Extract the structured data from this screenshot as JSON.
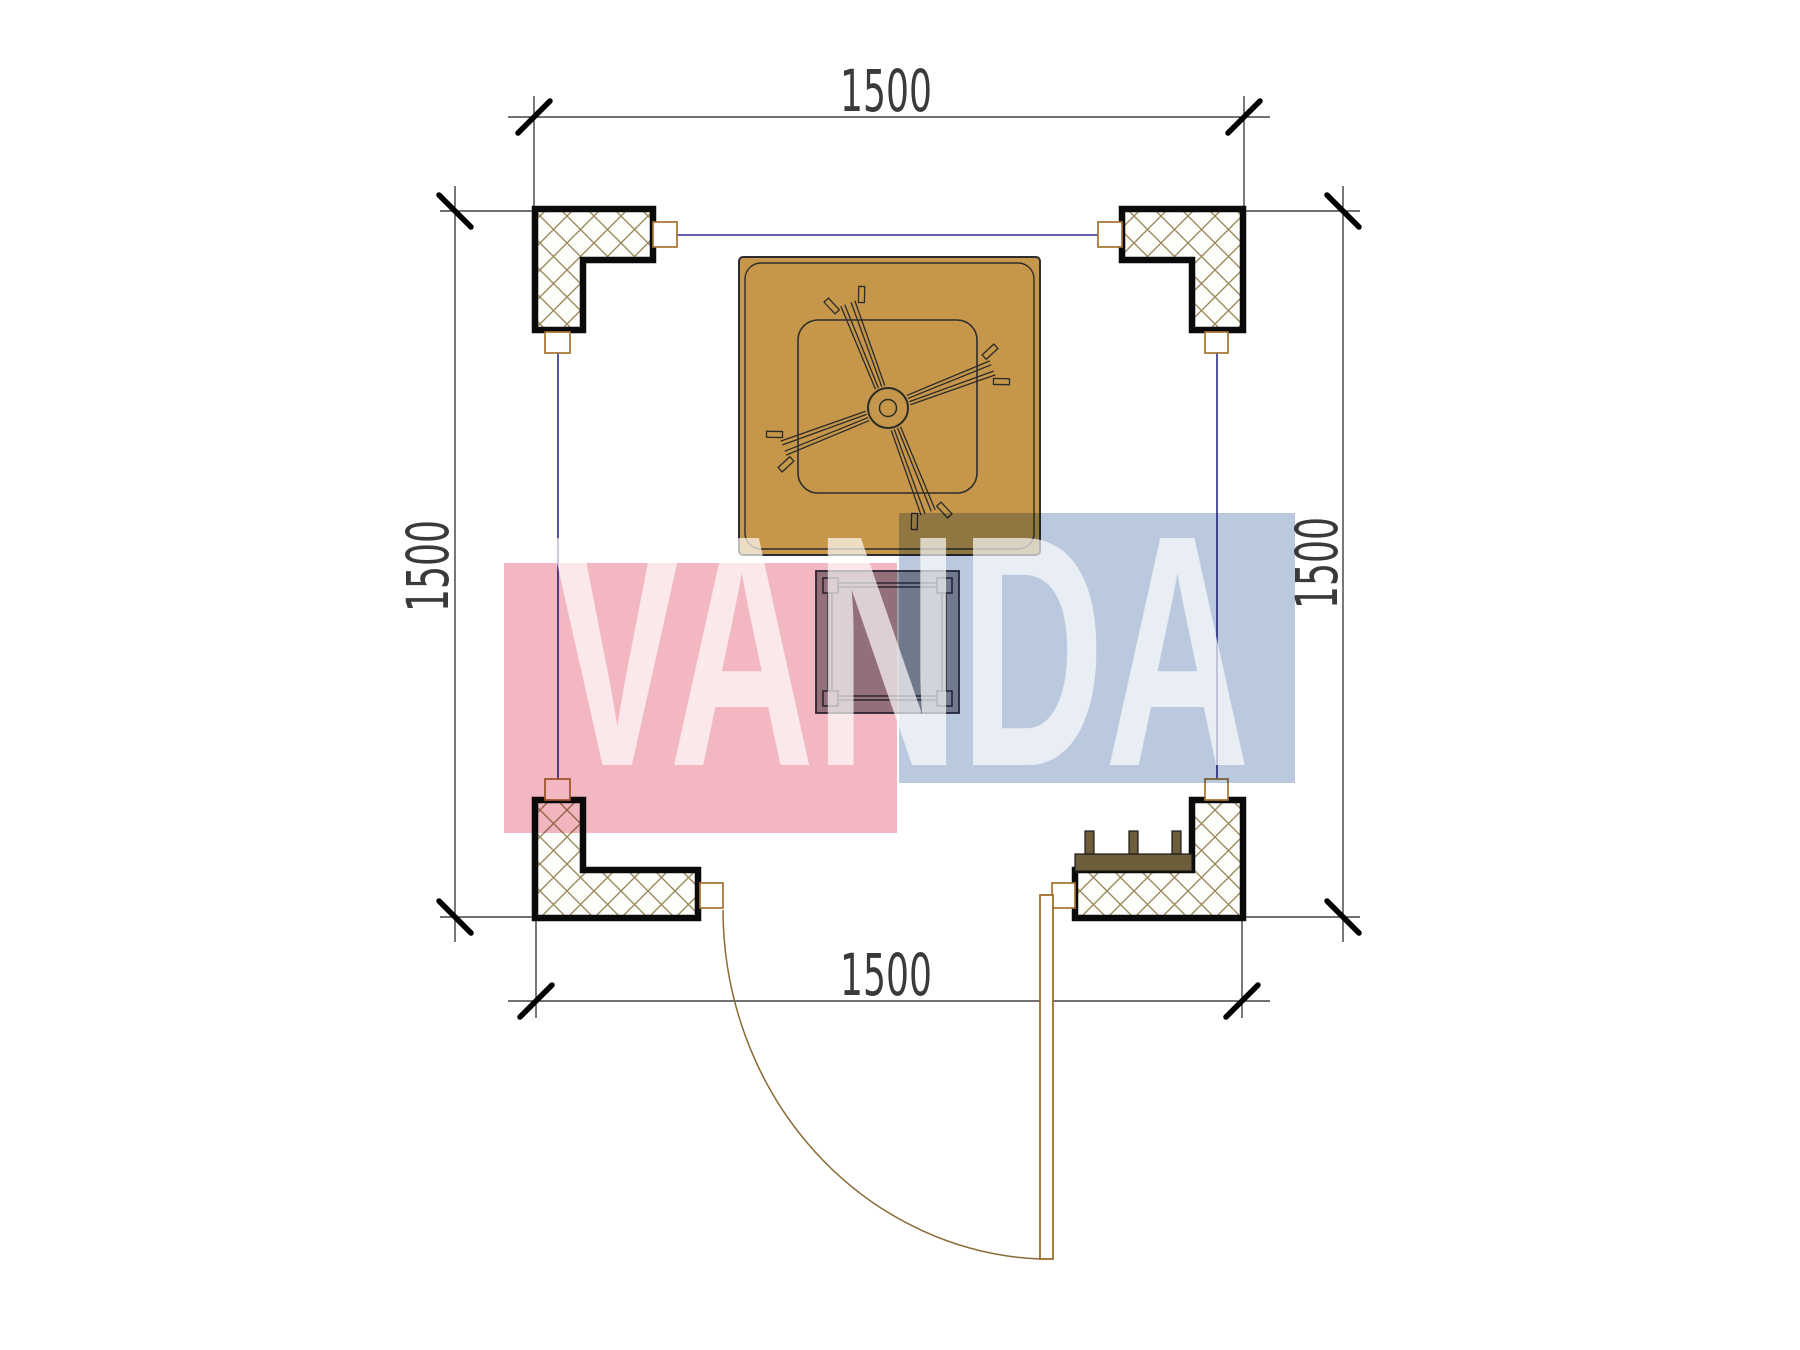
{
  "drawing_title": "pergola-floor-plan",
  "dimensions": {
    "top": "1500",
    "bottom": "1500",
    "left": "1500",
    "right": "1500"
  },
  "watermark": {
    "text": "VANDA",
    "pink_block_color": "#f2b7c1",
    "blue_block_color": "#bac9de",
    "text_color": "rgba(255,255,255,0.68)"
  },
  "colors": {
    "background": "#ffffff",
    "canopy_fill": "#c6974a",
    "canopy_line": "#2d2d2d",
    "hatch_line": "#9c8a5e",
    "column_outline": "#0a0a0a",
    "wall_line_blue": "#2b2c8a",
    "tab_outline": "#a5722f",
    "bench_fill": "#6d5d38",
    "door_leaf": "#9a6420",
    "door_arc": "#8a6a35",
    "table_fill": "#9b9ba1",
    "table_line": "#2e3040",
    "dim_line": "#1f1f1f",
    "tick": "#000000",
    "dim_text": "#3a3a3a"
  }
}
